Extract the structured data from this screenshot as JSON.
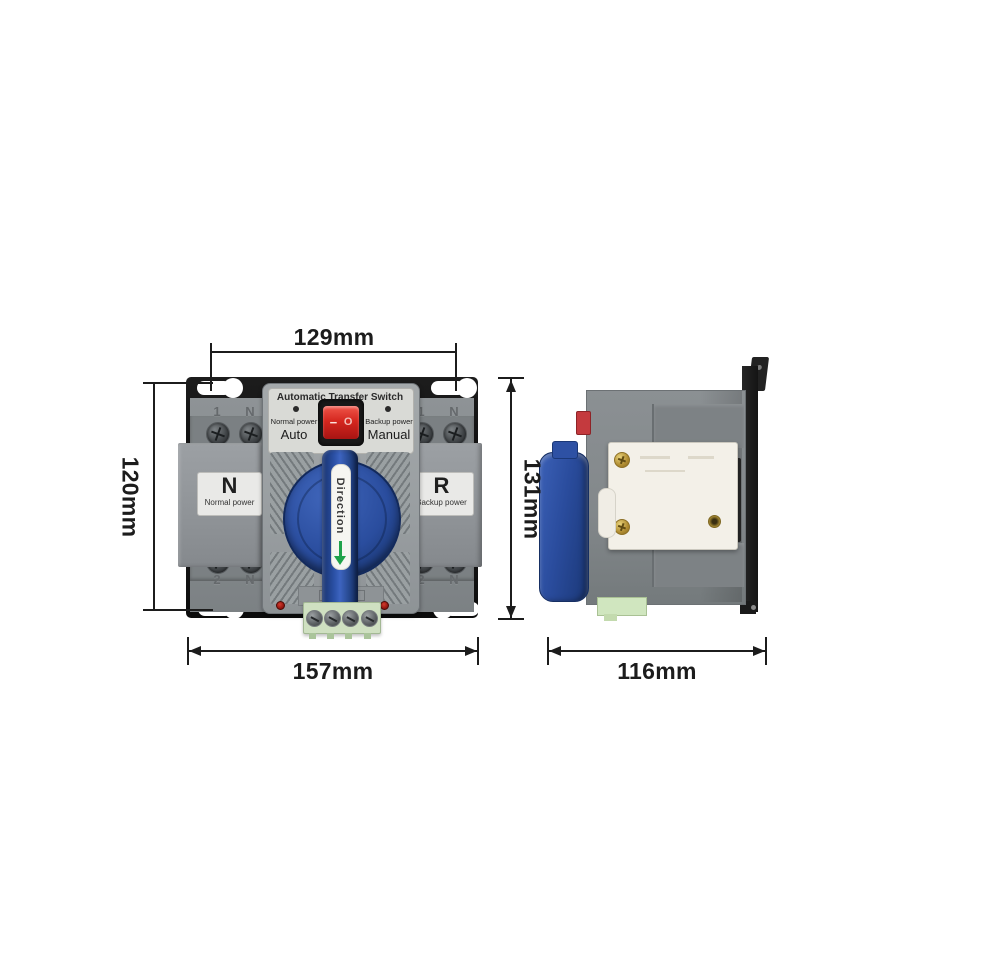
{
  "dimensions": {
    "mount_hole_spacing": "129mm",
    "mount_plate_height": "120mm",
    "overall_height": "131mm",
    "overall_width": "157mm",
    "side_depth": "116mm"
  },
  "front_view": {
    "panel": {
      "title": "Automatic Transfer Switch",
      "left_indicator": "Normal power",
      "left_mode": "Auto",
      "right_indicator": "Backup power",
      "right_mode": "Manual",
      "rocker_on": "−",
      "rocker_off": "O"
    },
    "left_pole": {
      "code": "N",
      "label": "Normal power"
    },
    "right_pole": {
      "code": "R",
      "label": "Backup power"
    },
    "handle": {
      "label": "Direction"
    },
    "terminals": {
      "top": [
        "1",
        "N",
        "1",
        "N"
      ],
      "bottom": [
        "2",
        "N",
        "2",
        "N"
      ]
    }
  },
  "colors": {
    "dimension_ink": "#1c1c1c",
    "plate_black": "#141414",
    "body_gray": "#868b8e",
    "panel_gray": "#9da2a4",
    "info_panel_gray": "#d9dad6",
    "handle_blue": "#2a4c9c",
    "rocker_red": "#d5271f",
    "terminal_green": "#cfe0c1",
    "direction_arrow_green": "#1fa24a",
    "breaker_white": "#f3f0e8"
  }
}
